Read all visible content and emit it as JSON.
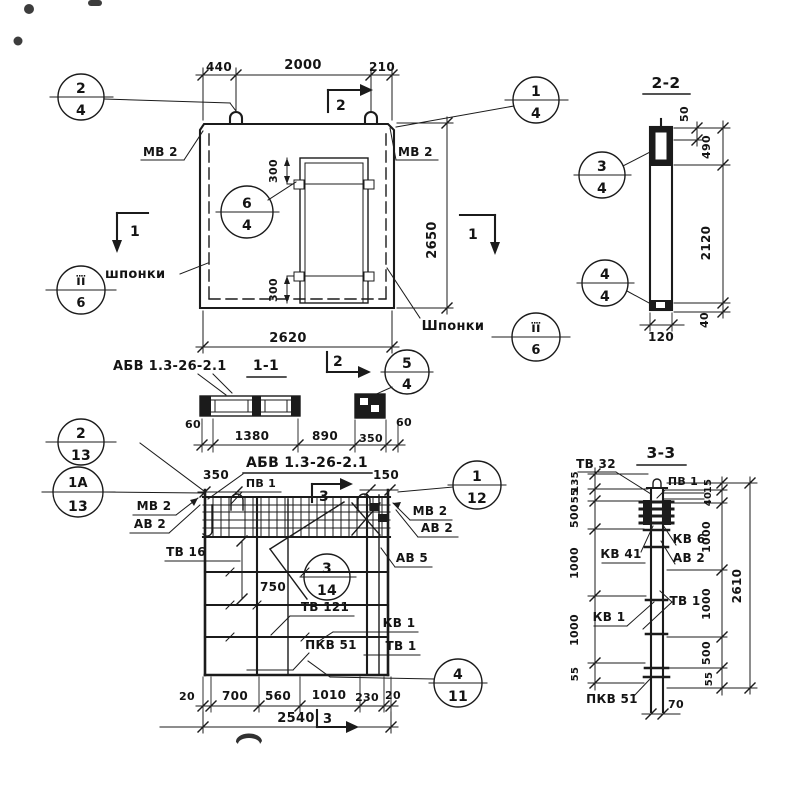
{
  "panel": {
    "callout_tl": {
      "top": "2",
      "bot": "4"
    },
    "callout_tr": {
      "top": "1",
      "bot": "4"
    },
    "callout_door": {
      "top": "6",
      "bot": "4"
    },
    "callout_keys_left": {
      "top": "ïï",
      "bot": "6"
    },
    "callout_keys_right": {
      "top": "ïï",
      "bot": "6"
    },
    "label_mv2_left": "МВ 2",
    "label_mv2_right": "МВ 2",
    "label_keys_left": "шпонки",
    "label_keys_right": "Шпонки",
    "dim_440": "440",
    "dim_2000": "2000",
    "dim_210": "210",
    "dim_2650": "2650",
    "dim_2620": "2620",
    "dim_300_top": "300",
    "dim_300_bot": "300",
    "cut_top": "2",
    "cut_bottom": "2",
    "cut_left": "1",
    "cut_right": "1"
  },
  "s22": {
    "title": "2-2",
    "c3": {
      "top": "3",
      "bot": "4"
    },
    "c4": {
      "top": "4",
      "bot": "4"
    },
    "d50": "50",
    "d490": "490",
    "d2120": "2120",
    "d40": "40",
    "d120": "120"
  },
  "s11": {
    "label": "АБВ 1.3-26-2.1",
    "title": "1-1",
    "c5": {
      "top": "5",
      "bot": "4"
    },
    "d60l": "60",
    "d1380": "1380",
    "d890": "890",
    "d350": "350",
    "d60r": "60"
  },
  "plan": {
    "title": "АБВ 1.3-26-2.1",
    "c2_13": {
      "top": "2",
      "bot": "13"
    },
    "c1a_13": {
      "top": "1А",
      "bot": "13"
    },
    "c1_12": {
      "top": "1",
      "bot": "12"
    },
    "c3_14": {
      "top": "3",
      "bot": "14"
    },
    "c4_11": {
      "top": "4",
      "bot": "11"
    },
    "pv1": "ПВ 1",
    "mv2_left": "МВ 2",
    "av2_left": "АВ 2",
    "tv16": "ТВ 16",
    "mv2_right": "МВ 2",
    "av2_right": "АВ 2",
    "av5": "АВ 5",
    "tv121": "ТВ 121",
    "kv1": "КВ 1",
    "tv1": "ТВ 1",
    "pkv51": "ПКВ 51",
    "d350": "350",
    "d150": "150",
    "d750": "750",
    "b20l": "20",
    "b700": "700",
    "b560": "560",
    "b1010": "1010",
    "b230": "230",
    "b20r": "20",
    "total": "2540",
    "cut_top": "3",
    "cut_bottom": "3"
  },
  "s33": {
    "title": "3-3",
    "tv32": "ТВ 32",
    "pv1": "ПВ 1",
    "kv41": "КВ 41",
    "kv6": "КВ 6",
    "av2": "АВ 2",
    "tv1": "ТВ 1",
    "kv1": "КВ 1",
    "pkv51": "ПКВ 51",
    "dl": [
      "135",
      "55",
      "500",
      "1000",
      "1000",
      "55"
    ],
    "dr": [
      "15",
      "40",
      "1000",
      "1000",
      "500",
      "55"
    ],
    "total": "2610",
    "d70": "70"
  }
}
